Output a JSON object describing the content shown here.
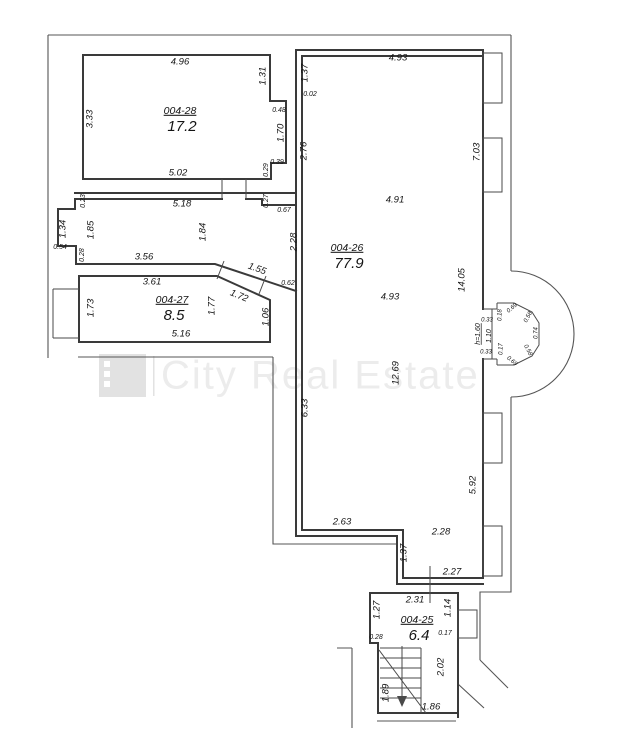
{
  "watermark": {
    "text": "City Real Estate"
  },
  "colors": {
    "wall": "#3a3a3a",
    "line": "#555555",
    "detail": "#4a4a4a",
    "text": "#141414",
    "wm-text": "#ececec",
    "wm-logo": "#e2e2e2"
  },
  "rooms": [
    {
      "number": "004-28",
      "area": "17.2",
      "x": 180,
      "y": 111
    },
    {
      "number": "004-26",
      "area": "77.9",
      "x": 347,
      "y": 248
    },
    {
      "number": "004-27",
      "area": "8.5",
      "x": 172,
      "y": 300
    },
    {
      "number": "004-25",
      "area": "6.4",
      "x": 417,
      "y": 620
    }
  ],
  "dimensions": [
    {
      "t": "4.96",
      "x": 180,
      "y": 62
    },
    {
      "t": "3.33",
      "x": 90,
      "y": 119,
      "r": -90
    },
    {
      "t": "1.31",
      "x": 263,
      "y": 76,
      "r": -90
    },
    {
      "t": "0.48",
      "x": 279,
      "y": 110,
      "s": "sm"
    },
    {
      "t": "1.70",
      "x": 281,
      "y": 133,
      "r": -90
    },
    {
      "t": "0.39",
      "x": 277,
      "y": 162,
      "s": "sm"
    },
    {
      "t": "0.29",
      "x": 266,
      "y": 170,
      "r": -90,
      "s": "sm"
    },
    {
      "t": "5.02",
      "x": 178,
      "y": 173
    },
    {
      "t": "5.18",
      "x": 182,
      "y": 204
    },
    {
      "t": "0.23",
      "x": 83,
      "y": 201,
      "r": -90,
      "s": "sm"
    },
    {
      "t": "0.27",
      "x": 266,
      "y": 201,
      "r": -90,
      "s": "sm"
    },
    {
      "t": "0.67",
      "x": 284,
      "y": 210,
      "s": "sm"
    },
    {
      "t": "4.93",
      "x": 398,
      "y": 58
    },
    {
      "t": "1.37",
      "x": 305,
      "y": 73,
      "r": -90
    },
    {
      "t": "0.02",
      "x": 310,
      "y": 94,
      "s": "sm"
    },
    {
      "t": "2.76",
      "x": 304,
      "y": 151,
      "r": -90
    },
    {
      "t": "7.03",
      "x": 477,
      "y": 152,
      "r": -90
    },
    {
      "t": "4.91",
      "x": 395,
      "y": 200
    },
    {
      "t": "14.05",
      "x": 462,
      "y": 280,
      "r": -90
    },
    {
      "t": "2.28",
      "x": 294,
      "y": 242,
      "r": -90
    },
    {
      "t": "4.93",
      "x": 390,
      "y": 297
    },
    {
      "t": "12.69",
      "x": 396,
      "y": 373,
      "r": -90
    },
    {
      "t": "6.33",
      "x": 305,
      "y": 408,
      "r": -90
    },
    {
      "t": "5.92",
      "x": 473,
      "y": 485,
      "r": -90
    },
    {
      "t": "1.34",
      "x": 63,
      "y": 229,
      "r": -90
    },
    {
      "t": "1.85",
      "x": 91,
      "y": 230,
      "r": -90
    },
    {
      "t": "1.84",
      "x": 203,
      "y": 232,
      "r": -90
    },
    {
      "t": "0.54",
      "x": 60,
      "y": 247,
      "s": "sm"
    },
    {
      "t": "0.28",
      "x": 82,
      "y": 255,
      "r": -90,
      "s": "sm"
    },
    {
      "t": "3.56",
      "x": 144,
      "y": 257
    },
    {
      "t": "3.61",
      "x": 152,
      "y": 282
    },
    {
      "t": "1.55",
      "x": 257,
      "y": 269,
      "r": 20
    },
    {
      "t": "1.72",
      "x": 239,
      "y": 296,
      "r": 22
    },
    {
      "t": "0.62",
      "x": 288,
      "y": 283,
      "s": "sm"
    },
    {
      "t": "1.77",
      "x": 212,
      "y": 306,
      "r": -90
    },
    {
      "t": "1.73",
      "x": 91,
      "y": 308,
      "r": -90
    },
    {
      "t": "1.06",
      "x": 266,
      "y": 317,
      "r": -90
    },
    {
      "t": "5.16",
      "x": 181,
      "y": 334
    },
    {
      "t": "h=1.60",
      "x": 478,
      "y": 334,
      "r": -90,
      "s": "sm",
      "u": true
    },
    {
      "t": "1.10",
      "x": 489,
      "y": 336,
      "r": -90,
      "s": "sm"
    },
    {
      "t": "0.33",
      "x": 487,
      "y": 320,
      "s": "xs"
    },
    {
      "t": "0.18",
      "x": 500,
      "y": 315,
      "r": -90,
      "s": "xs"
    },
    {
      "t": "0.69",
      "x": 512,
      "y": 308,
      "r": -40,
      "s": "xs"
    },
    {
      "t": "0.58",
      "x": 528,
      "y": 317,
      "r": -62,
      "s": "xs"
    },
    {
      "t": "0.74",
      "x": 536,
      "y": 333,
      "r": -90,
      "s": "xs"
    },
    {
      "t": "0.58",
      "x": 528,
      "y": 350,
      "r": 62,
      "s": "xs"
    },
    {
      "t": "0.69",
      "x": 512,
      "y": 361,
      "r": 40,
      "s": "xs"
    },
    {
      "t": "0.17",
      "x": 501,
      "y": 349,
      "r": -90,
      "s": "xs"
    },
    {
      "t": "0.33",
      "x": 486,
      "y": 352,
      "s": "xs"
    },
    {
      "t": "2.63",
      "x": 342,
      "y": 522
    },
    {
      "t": "2.28",
      "x": 441,
      "y": 532
    },
    {
      "t": "1.37",
      "x": 404,
      "y": 553,
      "r": -90
    },
    {
      "t": "2.27",
      "x": 452,
      "y": 572
    },
    {
      "t": "2.31",
      "x": 415,
      "y": 600
    },
    {
      "t": "1.27",
      "x": 377,
      "y": 610,
      "r": -90
    },
    {
      "t": "1.14",
      "x": 448,
      "y": 608,
      "r": -90
    },
    {
      "t": "0.28",
      "x": 376,
      "y": 637,
      "s": "sm"
    },
    {
      "t": "0.17",
      "x": 445,
      "y": 633,
      "s": "sm"
    },
    {
      "t": "2.02",
      "x": 441,
      "y": 667,
      "r": -90
    },
    {
      "t": "1.89",
      "x": 386,
      "y": 693,
      "r": -90
    },
    {
      "t": "1.86",
      "x": 431,
      "y": 707
    }
  ]
}
